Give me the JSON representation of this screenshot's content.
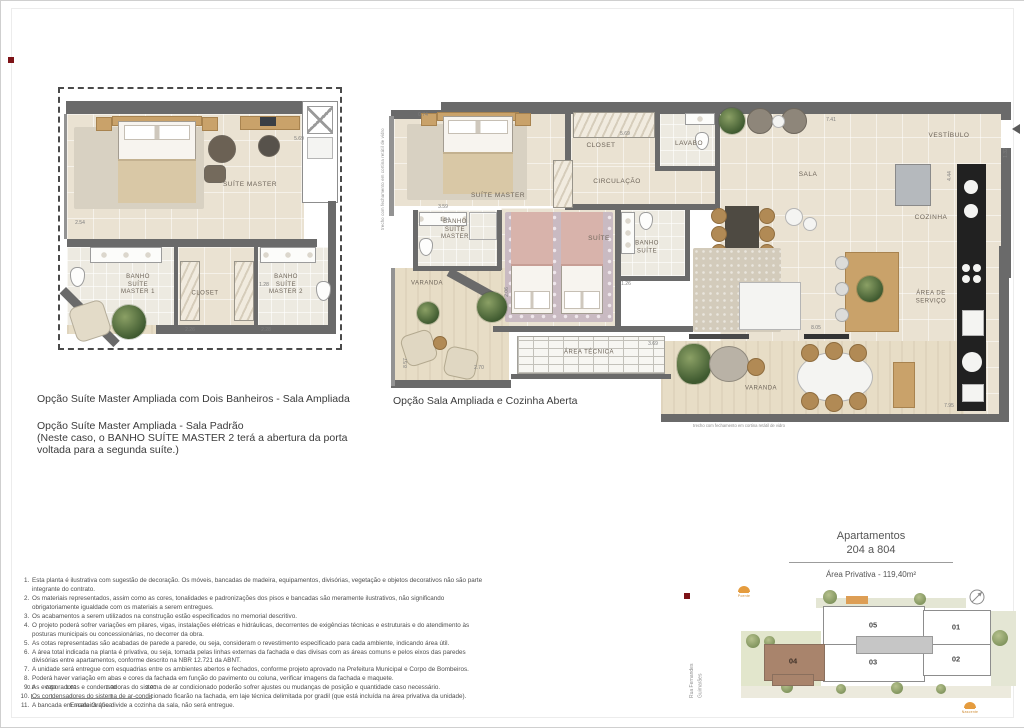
{
  "captions": {
    "left_option_1": "Opção Suíte Master Ampliada com Dois Banheiros - Sala Ampliada",
    "left_option_2": "Opção Suíte Master Ampliada - Sala Padrão",
    "left_option_2_note": "(Neste caso, o BANHO SUÍTE MASTER 2 terá a abertura da porta\nvoltada para a segunda suíte.)",
    "right_option": "Opção Sala Ampliada e Cozinha Aberta"
  },
  "plan_small": {
    "rooms": {
      "suite_master": "SUÍTE MASTER",
      "banho_suite_master_1": "BANHO\nSUÍTE\nMASTER 1",
      "banho_suite_master_2": "BANHO\nSUÍTE\nMASTER 2",
      "closet": "CLOSET"
    },
    "dims": {
      "d1": "2.54",
      "d2": "5.69",
      "d3": "1.28",
      "d4": "2.26",
      "d5": "2.28"
    }
  },
  "plan_large": {
    "rooms": {
      "suite_master": "SUÍTE MASTER",
      "closet": "CLOSET",
      "lavabo": "LAVABO",
      "circulacao": "CIRCULAÇÃO",
      "banho_suite_master": "BANHO\nSUÍTE\nMASTER",
      "suite": "SUÍTE",
      "banho_suite": "BANHO\nSUÍTE",
      "sala": "SALA",
      "vestibulo": "VESTÍBULO",
      "cozinha": "COZINHA",
      "area_servico": "ÁREA DE\nSERVIÇO",
      "area_tecnica": "ÁREA TÉCNICA",
      "varanda_oeste": "VARANDA",
      "varanda_sul": "VARANDA"
    },
    "glass_note": "trecho com fechamento em cortina retátil de vidro",
    "dims": {
      "d1": "0.74",
      "d2": "5.69",
      "d3": "7.41",
      "d4": "1.32",
      "d5": "3.59",
      "d6": "1.94",
      "d7": "2.06",
      "d8": "1.26",
      "d9": "3.69",
      "d10": "8.57",
      "d11": "2.70",
      "d12": "8.05",
      "d13": "7.95",
      "d14": "4.44"
    }
  },
  "notes": {
    "items": [
      "Esta planta é ilustrativa com sugestão de decoração. Os móveis, bancadas de madeira, equipamentos, divisórias, vegetação e objetos decorativos não são parte integrante do contrato.",
      "Os materiais representados, assim como as cores, tonalidades e padronizações dos pisos e bancadas são meramente ilustrativos, não significando obrigatoriamente igualdade com os materiais a serem entregues.",
      "Os acabamentos a serem utilizados na construção estão especificados no memorial descritivo.",
      "O projeto poderá sofrer variações em pilares, vigas, instalações elétricas e hidráulicas, decorrentes de exigências técnicas e estruturais e do atendimento às posturas municipais ou concessionárias, no decorrer da obra.",
      "As cotas representadas são acabadas de parede a parede, ou seja, consideram o revestimento especificado para cada ambiente, indicando área útil.",
      "A área total indicada na planta é privativa, ou seja, tomada pelas linhas externas da fachada e das divisas com as áreas comuns e pelos eixos das paredes divisórias entre apartamentos, conforme descrito na NBR 12.721 da ABNT.",
      "A unidade será entregue com esquadrias entre os ambientes abertos e fechados, conforme projeto aprovado na Prefeitura Municipal e Corpo de Bombeiros.",
      "Poderá haver variação em abas e cores da fachada em função do pavimento ou coluna, verificar imagens da fachada e maquete.",
      "As evaporadoras e condensadoras do sistema de ar condicionado poderão sofrer ajustes ou mudanças de posição e quantidade caso necessário.",
      "Os condensadores do sistema de ar-condicionado ficarão na fachada, em laje técnica delimitada por gradil (que está incluída na área privativa da unidade).",
      "A bancada em madeira que divide a cozinha da sala, não será entregue."
    ]
  },
  "scalebar": {
    "labels": [
      "0.0",
      "0.50",
      "1.00",
      "2.00",
      "3.00"
    ],
    "caption": "Escala Gráfica"
  },
  "unit_info": {
    "title": "Apartamentos\n204 a 804",
    "area": "Área Privativa  - 119,40m²"
  },
  "keyplan": {
    "street": "Rua Fernandes\nGuimarães",
    "units": {
      "u01": "01",
      "u02": "02",
      "u03": "03",
      "u04": "04",
      "u05": "05"
    },
    "sun_west": "Poente",
    "sun_east": "Nascente",
    "highlight_color": "#a9846c"
  }
}
